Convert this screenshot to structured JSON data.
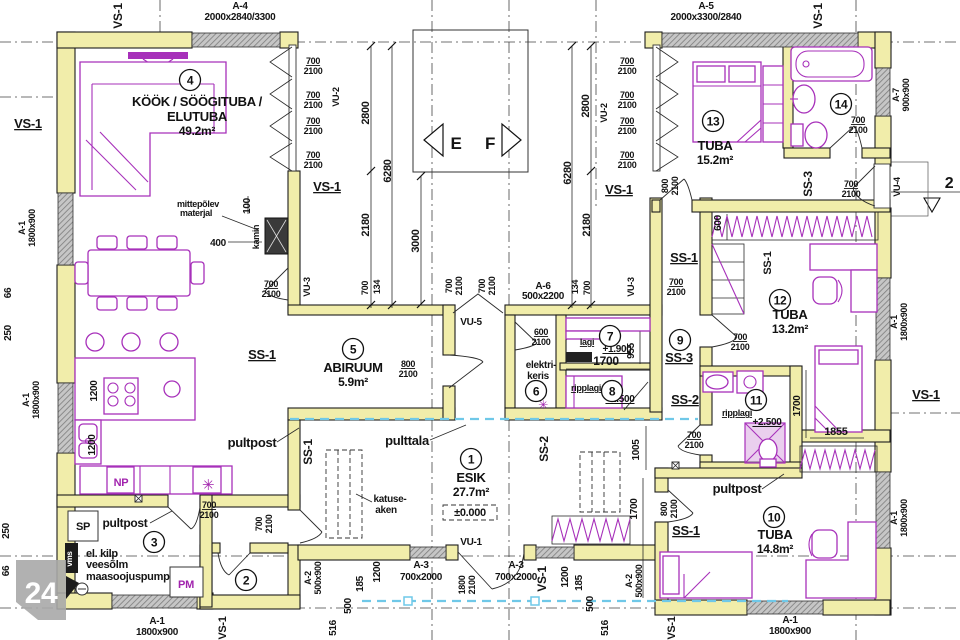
{
  "plan": {
    "watermark": "24",
    "colors": {
      "wall": "#f1edaa",
      "furniture": "#a730ba",
      "window": "#c2c2c2",
      "blue_line": "#6fc8e8"
    },
    "rooms": [
      {
        "n": "1",
        "cx": 471,
        "cy": 459,
        "name": "ESIK",
        "area": "27.7m²",
        "tx": 471,
        "ty": 482
      },
      {
        "n": "2",
        "cx": 246,
        "cy": 580
      },
      {
        "n": "3",
        "cx": 154,
        "cy": 542
      },
      {
        "n": "4",
        "cx": 190,
        "cy": 80,
        "name": "KÖÖK / SÖÖGITUBA /",
        "name2": "ELUTUBA",
        "area": "49.2m²",
        "tx": 197,
        "ty": 106
      },
      {
        "n": "5",
        "cx": 353,
        "cy": 349,
        "name": "ABIRUUM",
        "area": "5.9m²",
        "tx": 353,
        "ty": 372
      },
      {
        "n": "6",
        "cx": 536,
        "cy": 391
      },
      {
        "n": "7",
        "cx": 610,
        "cy": 336
      },
      {
        "n": "8",
        "cx": 612,
        "cy": 391
      },
      {
        "n": "9",
        "cx": 680,
        "cy": 340
      },
      {
        "n": "10",
        "cx": 774,
        "cy": 517,
        "name": "TUBA",
        "area": "14.8m²",
        "tx": 775,
        "ty": 539
      },
      {
        "n": "11",
        "cx": 756,
        "cy": 400
      },
      {
        "n": "12",
        "cx": 780,
        "cy": 300,
        "name": "TUBA",
        "area": "13.2m²",
        "tx": 790,
        "ty": 319
      },
      {
        "n": "13",
        "cx": 713,
        "cy": 121,
        "name": "TUBA",
        "area": "15.2m²",
        "tx": 715,
        "ty": 150
      },
      {
        "n": "14",
        "cx": 841,
        "cy": 104
      }
    ],
    "labels": [
      {
        "t": "VS-1",
        "x": 122,
        "y": 16,
        "r": -90,
        "s": 12
      },
      {
        "t": "A-4",
        "x": 240,
        "y": 9,
        "s": 10
      },
      {
        "t": "2000x2840/3300",
        "x": 240,
        "y": 20,
        "s": 10
      },
      {
        "t": "A-5",
        "x": 706,
        "y": 9,
        "s": 10
      },
      {
        "t": "2000x3300/2840",
        "x": 706,
        "y": 20,
        "s": 10
      },
      {
        "t": "VS-1",
        "x": 822,
        "y": 16,
        "r": -90,
        "s": 12
      },
      {
        "t": "A-7",
        "x": 899,
        "y": 95,
        "r": -90,
        "s": 9
      },
      {
        "t": "900x900",
        "x": 909,
        "y": 95,
        "r": -90,
        "s": 9
      },
      {
        "t": "VU-4",
        "x": 900,
        "y": 187,
        "r": -90,
        "s": 9
      },
      {
        "t": "2",
        "x": 949,
        "y": 188,
        "s": 16
      },
      {
        "t": "A-1",
        "x": 897,
        "y": 322,
        "r": -90,
        "s": 9
      },
      {
        "t": "1800x900",
        "x": 907,
        "y": 322,
        "r": -90,
        "s": 9
      },
      {
        "t": "VS-1",
        "x": 926,
        "y": 399,
        "s": 13,
        "u": 1
      },
      {
        "t": "A-1",
        "x": 897,
        "y": 518,
        "r": -90,
        "s": 9
      },
      {
        "t": "1800x900",
        "x": 907,
        "y": 518,
        "r": -90,
        "s": 9
      },
      {
        "t": "VS-1",
        "x": 28,
        "y": 128,
        "s": 13,
        "u": 1
      },
      {
        "t": "A-1",
        "x": 25,
        "y": 228,
        "r": -90,
        "s": 9
      },
      {
        "t": "1800x900",
        "x": 35,
        "y": 228,
        "r": -90,
        "s": 9
      },
      {
        "t": "66",
        "x": 11,
        "y": 293,
        "r": -90,
        "s": 10
      },
      {
        "t": "250",
        "x": 11,
        "y": 333,
        "r": -90,
        "s": 10
      },
      {
        "t": "A-1",
        "x": 29,
        "y": 400,
        "r": -90,
        "s": 9
      },
      {
        "t": "1800x900",
        "x": 39,
        "y": 400,
        "r": -90,
        "s": 9
      },
      {
        "t": "250",
        "x": 9,
        "y": 531,
        "r": -90,
        "s": 10
      },
      {
        "t": "66",
        "x": 9,
        "y": 571,
        "r": -90,
        "s": 10
      },
      {
        "t": "A-1",
        "x": 157,
        "y": 624,
        "s": 10
      },
      {
        "t": "1800x900",
        "x": 157,
        "y": 635,
        "s": 10
      },
      {
        "t": "VS-1",
        "x": 226,
        "y": 628,
        "r": -90,
        "s": 11
      },
      {
        "t": "A-2",
        "x": 311,
        "y": 578,
        "r": -90,
        "s": 9
      },
      {
        "t": "500x900",
        "x": 321,
        "y": 578,
        "r": -90,
        "s": 9
      },
      {
        "t": "516",
        "x": 336,
        "y": 628,
        "r": -90,
        "s": 10
      },
      {
        "t": "500",
        "x": 351,
        "y": 606,
        "r": -90,
        "s": 10
      },
      {
        "t": "185",
        "x": 363,
        "y": 584,
        "r": -90,
        "s": 10
      },
      {
        "t": "1200",
        "x": 380,
        "y": 572,
        "r": -90,
        "s": 10
      },
      {
        "t": "A-3",
        "x": 421,
        "y": 568,
        "s": 10
      },
      {
        "t": "700x2000",
        "x": 421,
        "y": 580,
        "s": 10
      },
      {
        "t": "VU-1",
        "x": 471,
        "y": 545,
        "s": 10
      },
      {
        "t": "1800",
        "x": 465,
        "y": 585,
        "r": -90,
        "s": 9
      },
      {
        "t": "2100",
        "x": 475,
        "y": 585,
        "r": -90,
        "s": 9
      },
      {
        "t": "A-3",
        "x": 516,
        "y": 568,
        "s": 10
      },
      {
        "t": "700x2000",
        "x": 516,
        "y": 580,
        "s": 10
      },
      {
        "t": "VS-1",
        "x": 546,
        "y": 579,
        "r": -90,
        "s": 12
      },
      {
        "t": "1200",
        "x": 568,
        "y": 577,
        "r": -90,
        "s": 10
      },
      {
        "t": "185",
        "x": 582,
        "y": 583,
        "r": -90,
        "s": 10
      },
      {
        "t": "500",
        "x": 593,
        "y": 604,
        "r": -90,
        "s": 10
      },
      {
        "t": "516",
        "x": 608,
        "y": 628,
        "r": -90,
        "s": 10
      },
      {
        "t": "A-2",
        "x": 632,
        "y": 581,
        "r": -90,
        "s": 9
      },
      {
        "t": "500x900",
        "x": 642,
        "y": 581,
        "r": -90,
        "s": 9
      },
      {
        "t": "VS-1",
        "x": 675,
        "y": 628,
        "r": -90,
        "s": 11
      },
      {
        "t": "A-1",
        "x": 790,
        "y": 623,
        "s": 10
      },
      {
        "t": "1800x900",
        "x": 790,
        "y": 634,
        "s": 10
      },
      {
        "t": "mittepõlev",
        "x": 198,
        "y": 207,
        "s": 9
      },
      {
        "t": "materjal",
        "x": 196,
        "y": 216,
        "s": 9
      },
      {
        "t": "100",
        "x": 250,
        "y": 206,
        "r": -90,
        "s": 10
      },
      {
        "t": "400",
        "x": 218,
        "y": 246,
        "s": 10
      },
      {
        "t": "kamin",
        "x": 259,
        "y": 237,
        "r": -90,
        "s": 9
      },
      {
        "t": "700",
        "x": 271,
        "y": 287,
        "s": 9,
        "u": 1
      },
      {
        "t": "2100",
        "x": 271,
        "y": 297,
        "s": 9
      },
      {
        "t": "SS-1",
        "x": 262,
        "y": 359,
        "s": 13,
        "u": 1
      },
      {
        "t": "1200",
        "x": 97,
        "y": 391,
        "r": -90,
        "s": 10
      },
      {
        "t": "1200",
        "x": 95,
        "y": 445,
        "r": -90,
        "s": 10
      },
      {
        "t": "NP",
        "x": 121,
        "y": 486,
        "s": 11,
        "c": "#a123ad"
      },
      {
        "t": "✳",
        "x": 208,
        "y": 490,
        "s": 15,
        "c": "#a123ad"
      },
      {
        "t": "✳",
        "x": 543,
        "y": 409,
        "s": 12,
        "c": "#a123ad"
      },
      {
        "t": "700",
        "x": 313,
        "y": 64,
        "s": 9,
        "u": 1
      },
      {
        "t": "2100",
        "x": 313,
        "y": 74,
        "s": 9
      },
      {
        "t": "700",
        "x": 313,
        "y": 98,
        "s": 9,
        "u": 1
      },
      {
        "t": "2100",
        "x": 313,
        "y": 108,
        "s": 9
      },
      {
        "t": "700",
        "x": 313,
        "y": 124,
        "s": 9,
        "u": 1
      },
      {
        "t": "2100",
        "x": 313,
        "y": 134,
        "s": 9
      },
      {
        "t": "700",
        "x": 313,
        "y": 158,
        "s": 9,
        "u": 1
      },
      {
        "t": "2100",
        "x": 313,
        "y": 168,
        "s": 9
      },
      {
        "t": "700",
        "x": 627,
        "y": 64,
        "s": 9,
        "u": 1
      },
      {
        "t": "2100",
        "x": 627,
        "y": 74,
        "s": 9
      },
      {
        "t": "700",
        "x": 627,
        "y": 98,
        "s": 9,
        "u": 1
      },
      {
        "t": "2100",
        "x": 627,
        "y": 108,
        "s": 9
      },
      {
        "t": "700",
        "x": 627,
        "y": 124,
        "s": 9,
        "u": 1
      },
      {
        "t": "2100",
        "x": 627,
        "y": 134,
        "s": 9
      },
      {
        "t": "700",
        "x": 627,
        "y": 158,
        "s": 9,
        "u": 1
      },
      {
        "t": "2100",
        "x": 627,
        "y": 168,
        "s": 9
      },
      {
        "t": "VU-2",
        "x": 339,
        "y": 97,
        "r": -90,
        "s": 9
      },
      {
        "t": "VU-2",
        "x": 607,
        "y": 113,
        "r": -90,
        "s": 9
      },
      {
        "t": "2800",
        "x": 369,
        "y": 113,
        "r": -90,
        "s": 11
      },
      {
        "t": "6280",
        "x": 391,
        "y": 171,
        "r": -90,
        "s": 11
      },
      {
        "t": "2180",
        "x": 369,
        "y": 225,
        "r": -90,
        "s": 11
      },
      {
        "t": "700",
        "x": 368,
        "y": 288,
        "r": -90,
        "s": 9
      },
      {
        "t": "134",
        "x": 380,
        "y": 287,
        "r": -90,
        "s": 9
      },
      {
        "t": "3000",
        "x": 419,
        "y": 241,
        "r": -90,
        "s": 11
      },
      {
        "t": "2800",
        "x": 589,
        "y": 106,
        "r": -90,
        "s": 11
      },
      {
        "t": "6280",
        "x": 571,
        "y": 173,
        "r": -90,
        "s": 11
      },
      {
        "t": "2180",
        "x": 590,
        "y": 225,
        "r": -90,
        "s": 11
      },
      {
        "t": "134",
        "x": 578,
        "y": 287,
        "r": -90,
        "s": 9
      },
      {
        "t": "700",
        "x": 590,
        "y": 288,
        "r": -90,
        "s": 9
      },
      {
        "t": "VS-1",
        "x": 327,
        "y": 191,
        "s": 13,
        "u": 1
      },
      {
        "t": "VS-1",
        "x": 619,
        "y": 194,
        "s": 13,
        "u": 1
      },
      {
        "t": "VU-3",
        "x": 310,
        "y": 287,
        "r": -90,
        "s": 9
      },
      {
        "t": "VU-3",
        "x": 634,
        "y": 287,
        "r": -90,
        "s": 9
      },
      {
        "t": "E",
        "x": 456,
        "y": 149,
        "s": 17
      },
      {
        "t": "F",
        "x": 490,
        "y": 149,
        "s": 17
      },
      {
        "t": "VU-5",
        "x": 471,
        "y": 325,
        "s": 10
      },
      {
        "t": "700",
        "x": 452,
        "y": 286,
        "r": -90,
        "s": 9
      },
      {
        "t": "2100",
        "x": 462,
        "y": 286,
        "r": -90,
        "s": 9
      },
      {
        "t": "700",
        "x": 485,
        "y": 286,
        "r": -90,
        "s": 9
      },
      {
        "t": "2100",
        "x": 495,
        "y": 286,
        "r": -90,
        "s": 9
      },
      {
        "t": "A-6",
        "x": 543,
        "y": 289,
        "s": 10
      },
      {
        "t": "500x2200",
        "x": 543,
        "y": 299,
        "s": 10
      },
      {
        "t": "800",
        "x": 408,
        "y": 367,
        "s": 9,
        "u": 1
      },
      {
        "t": "2100",
        "x": 408,
        "y": 377,
        "s": 9
      },
      {
        "t": "600",
        "x": 541,
        "y": 335,
        "s": 9,
        "u": 1
      },
      {
        "t": "2100",
        "x": 541,
        "y": 345,
        "s": 9
      },
      {
        "t": "elektri-",
        "x": 541,
        "y": 368,
        "s": 10
      },
      {
        "t": "keris",
        "x": 538,
        "y": 379,
        "s": 10
      },
      {
        "t": "lagi",
        "x": 587,
        "y": 345,
        "s": 9,
        "u": 1
      },
      {
        "t": "+1.900",
        "x": 617,
        "y": 352,
        "s": 10,
        "u": 1
      },
      {
        "t": "1700",
        "x": 606,
        "y": 365,
        "s": 12
      },
      {
        "t": "955",
        "x": 634,
        "y": 351,
        "r": -90,
        "s": 10
      },
      {
        "t": "ripplagi",
        "x": 586,
        "y": 391,
        "s": 9,
        "u": 1
      },
      {
        "t": "+2.500",
        "x": 620,
        "y": 402,
        "s": 10,
        "u": 1
      },
      {
        "t": "SS-3",
        "x": 679,
        "y": 362,
        "s": 13,
        "u": 1
      },
      {
        "t": "SS-2",
        "x": 685,
        "y": 404,
        "s": 13,
        "u": 1
      },
      {
        "t": "SS-2",
        "x": 548,
        "y": 449,
        "r": -90,
        "s": 12
      },
      {
        "t": "SS-1",
        "x": 312,
        "y": 452,
        "r": -90,
        "s": 12
      },
      {
        "t": "1005",
        "x": 639,
        "y": 450,
        "r": -90,
        "s": 10
      },
      {
        "t": "1700",
        "x": 637,
        "y": 509,
        "r": -90,
        "s": 10
      },
      {
        "t": "800",
        "x": 668,
        "y": 186,
        "r": -90,
        "s": 9
      },
      {
        "t": "2100",
        "x": 678,
        "y": 186,
        "r": -90,
        "s": 9
      },
      {
        "t": "700",
        "x": 858,
        "y": 123,
        "s": 9,
        "u": 1
      },
      {
        "t": "2100",
        "x": 858,
        "y": 133,
        "s": 9
      },
      {
        "t": "SS-3",
        "x": 812,
        "y": 184,
        "r": -90,
        "s": 12
      },
      {
        "t": "700",
        "x": 851,
        "y": 187,
        "s": 9,
        "u": 1
      },
      {
        "t": "2100",
        "x": 851,
        "y": 197,
        "s": 9
      },
      {
        "t": "600",
        "x": 721,
        "y": 223,
        "r": -90,
        "s": 10
      },
      {
        "t": "SS-1",
        "x": 684,
        "y": 262,
        "s": 13,
        "u": 1
      },
      {
        "t": "700",
        "x": 676,
        "y": 285,
        "s": 9,
        "u": 1
      },
      {
        "t": "2100",
        "x": 676,
        "y": 295,
        "s": 9
      },
      {
        "t": "SS-1",
        "x": 771,
        "y": 263,
        "r": -90,
        "s": 11
      },
      {
        "t": "700",
        "x": 740,
        "y": 340,
        "s": 9,
        "u": 1
      },
      {
        "t": "2100",
        "x": 740,
        "y": 350,
        "s": 9
      },
      {
        "t": "1700",
        "x": 800,
        "y": 406,
        "r": -90,
        "s": 10
      },
      {
        "t": "1855",
        "x": 836,
        "y": 435,
        "s": 11
      },
      {
        "t": "ripplagi",
        "x": 737,
        "y": 416,
        "s": 9,
        "u": 1
      },
      {
        "t": "+2.500",
        "x": 767,
        "y": 425,
        "s": 10,
        "u": 1
      },
      {
        "t": "700",
        "x": 694,
        "y": 438,
        "s": 9,
        "u": 1
      },
      {
        "t": "2100",
        "x": 694,
        "y": 448,
        "s": 9
      },
      {
        "t": "pultpost",
        "x": 737,
        "y": 493,
        "s": 13
      },
      {
        "t": "800",
        "x": 667,
        "y": 509,
        "r": -90,
        "s": 9
      },
      {
        "t": "2100",
        "x": 677,
        "y": 509,
        "r": -90,
        "s": 9
      },
      {
        "t": "SS-1",
        "x": 686,
        "y": 535,
        "s": 13,
        "u": 1
      },
      {
        "t": "pulttala",
        "x": 407,
        "y": 445,
        "s": 13
      },
      {
        "t": "katuse-",
        "x": 390,
        "y": 502,
        "s": 10
      },
      {
        "t": "aken",
        "x": 386,
        "y": 513,
        "s": 10
      },
      {
        "t": "±0.000",
        "x": 470,
        "y": 516,
        "s": 11
      },
      {
        "t": "pultpost",
        "x": 252,
        "y": 447,
        "s": 13
      },
      {
        "t": "700",
        "x": 209,
        "y": 508,
        "s": 9,
        "u": 1
      },
      {
        "t": "2100",
        "x": 209,
        "y": 518,
        "s": 9
      },
      {
        "t": "700",
        "x": 262,
        "y": 524,
        "r": -90,
        "s": 9
      },
      {
        "t": "2100",
        "x": 272,
        "y": 524,
        "r": -90,
        "s": 9
      },
      {
        "t": "SP",
        "x": 83,
        "y": 530,
        "s": 11
      },
      {
        "t": "pultpost",
        "x": 125,
        "y": 527,
        "s": 12
      },
      {
        "t": "el. kilp",
        "x": 86,
        "y": 557,
        "s": 11,
        "a": "start"
      },
      {
        "t": "veesõlm",
        "x": 86,
        "y": 568,
        "s": 11,
        "a": "start"
      },
      {
        "t": "maasoojuspump",
        "x": 86,
        "y": 580,
        "s": 11,
        "a": "start"
      },
      {
        "t": "PM",
        "x": 186,
        "y": 588,
        "s": 11,
        "c": "#a123ad"
      },
      {
        "t": "vms",
        "x": 72,
        "y": 559,
        "r": -90,
        "s": 8,
        "c": "#ffffff"
      }
    ]
  }
}
